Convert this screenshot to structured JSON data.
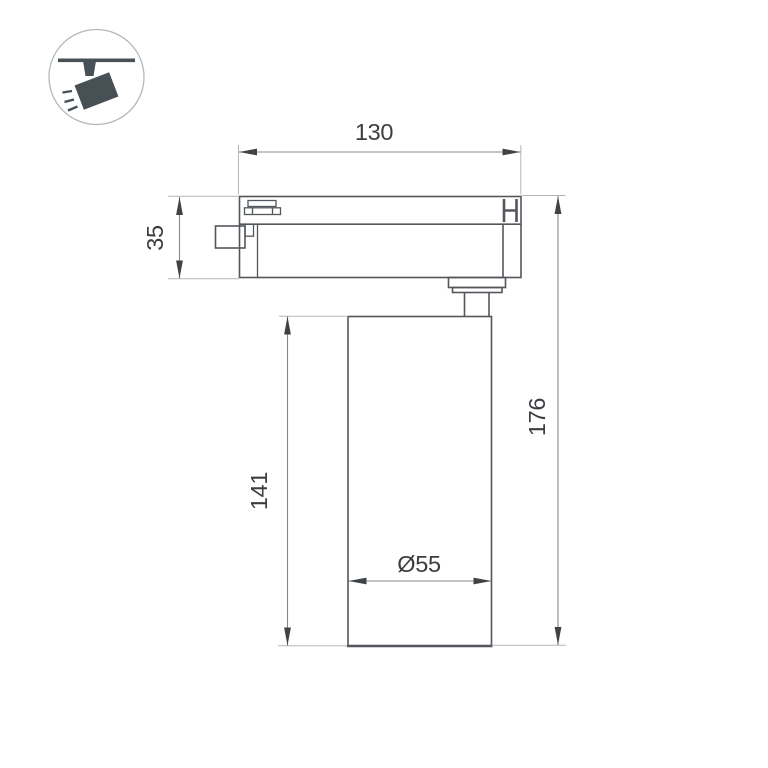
{
  "page": {
    "background": "#ffffff",
    "type_label": "technical-dimension-drawing"
  },
  "icon": {
    "name": "track-ceiling-spotlight",
    "color": "#475055",
    "circle_color": "#b5b8ba"
  },
  "drawing": {
    "colors": {
      "object_line": "#53575b",
      "dim_line": "#85898c",
      "ext_line": "#b4b7ba",
      "arrow": "#3f4346",
      "text": "#3b3e41"
    },
    "dimensions": {
      "track_width": {
        "label": "130"
      },
      "adapter_height": {
        "label": "35"
      },
      "body_height": {
        "label": "141"
      },
      "total_height": {
        "label": "176"
      },
      "diameter": {
        "label": "Ø55"
      }
    }
  }
}
